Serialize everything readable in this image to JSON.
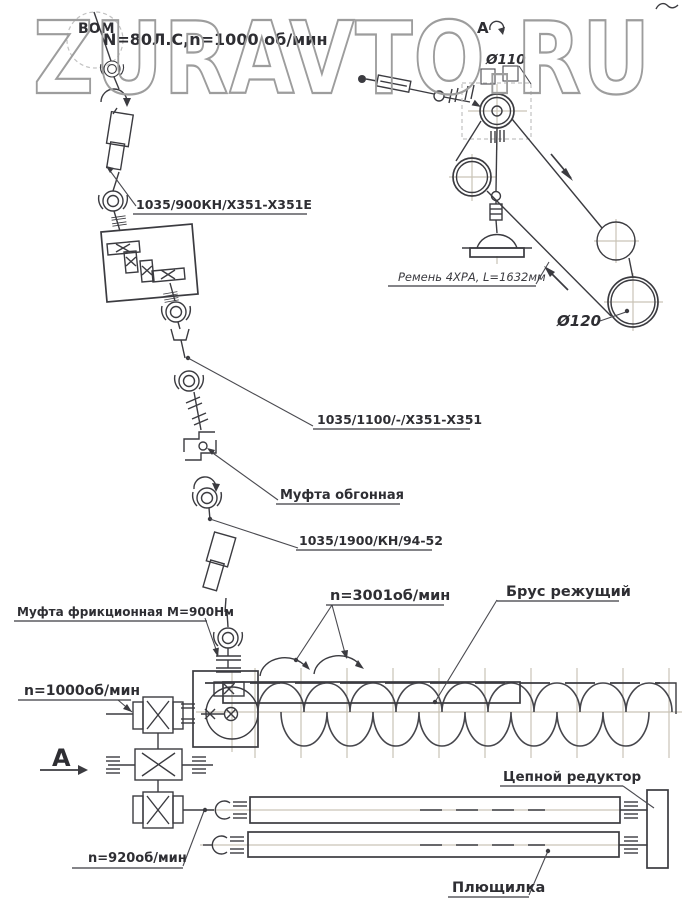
{
  "watermark": "ZURAVTO.RU",
  "colors": {
    "line": "#3b3b40",
    "aux_line": "#c9c3b6",
    "watermark": "#9d9d9d",
    "label": "#2e2e33"
  },
  "labels": {
    "pto": "ВОМ",
    "input_spec": "N=80Л.С,n=1000 об/мин",
    "driveshaft_1": "1035/900КН/Х351-Х351Е",
    "driveshaft_2": "1035/1100/-/Х351-Х351",
    "overrunning_clutch": "Муфта обгонная",
    "driveshaft_3": "1035/1900/КН/94-52",
    "friction_clutch": "Муфта фрикционная М=900Нм",
    "auger_speed": "n=3001об/мин",
    "cutter_bar": "Брус режущий",
    "main_gearbox_speed": "n=1000об/мин",
    "view_letter": "А",
    "roller_speed": "n=920об/мин",
    "chain_reducer": "Цепной редуктор",
    "conditioner": "Плющилка",
    "view_marker_letter": "А",
    "pulley_small_dia": "Ø110",
    "pulley_large_dia": "Ø120",
    "belt_spec": "Ремень 4ХРА, L=1632мм"
  }
}
